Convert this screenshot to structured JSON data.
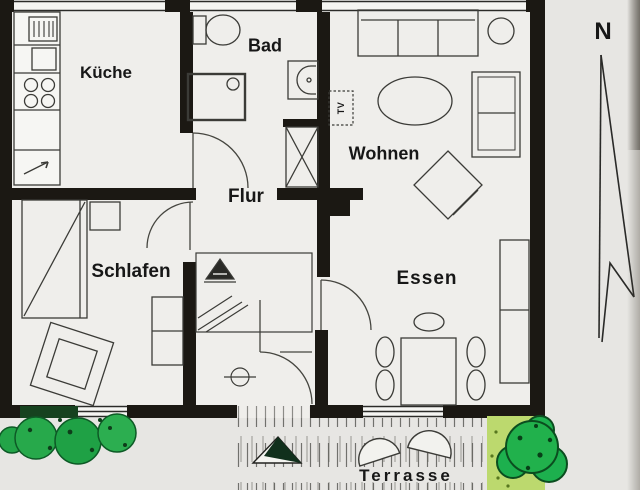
{
  "diagram": {
    "type": "apartment-floor-plan",
    "labels": {
      "kueche": "Küche",
      "bad": "Bad",
      "wohnen": "Wohnen",
      "flur": "Flur",
      "schlafen": "Schlafen",
      "essen": "Essen",
      "terrasse": "Terrasse",
      "tv": "TV",
      "compass_n": "N"
    },
    "furniture_icons": [
      "kitchen-counter-icon",
      "stove-burners-icon",
      "kitchen-sink-icon",
      "toilet-icon",
      "shower-icon",
      "washbasin-icon",
      "shaft-icon",
      "sofa-icon",
      "coffee-table-icon",
      "side-table-icon",
      "armchair-icon",
      "tv-icon",
      "dining-table-icon",
      "dining-chair-icon",
      "sideboard-icon",
      "bed-icon",
      "nightstand-icon",
      "wardrobe-icon",
      "reading-chair-icon",
      "patio-chair-icon",
      "entry-step-marker-icon",
      "shrub-icon",
      "north-arrow-icon"
    ],
    "colors": {
      "wall": "#1b1813",
      "floor": "#efeeeb",
      "background": "#e7e6e3",
      "line": "#3b3b37",
      "bush_green": "#24a94c",
      "bush_dark": "#0d4f20",
      "grass_light": "#bcd96e"
    }
  }
}
